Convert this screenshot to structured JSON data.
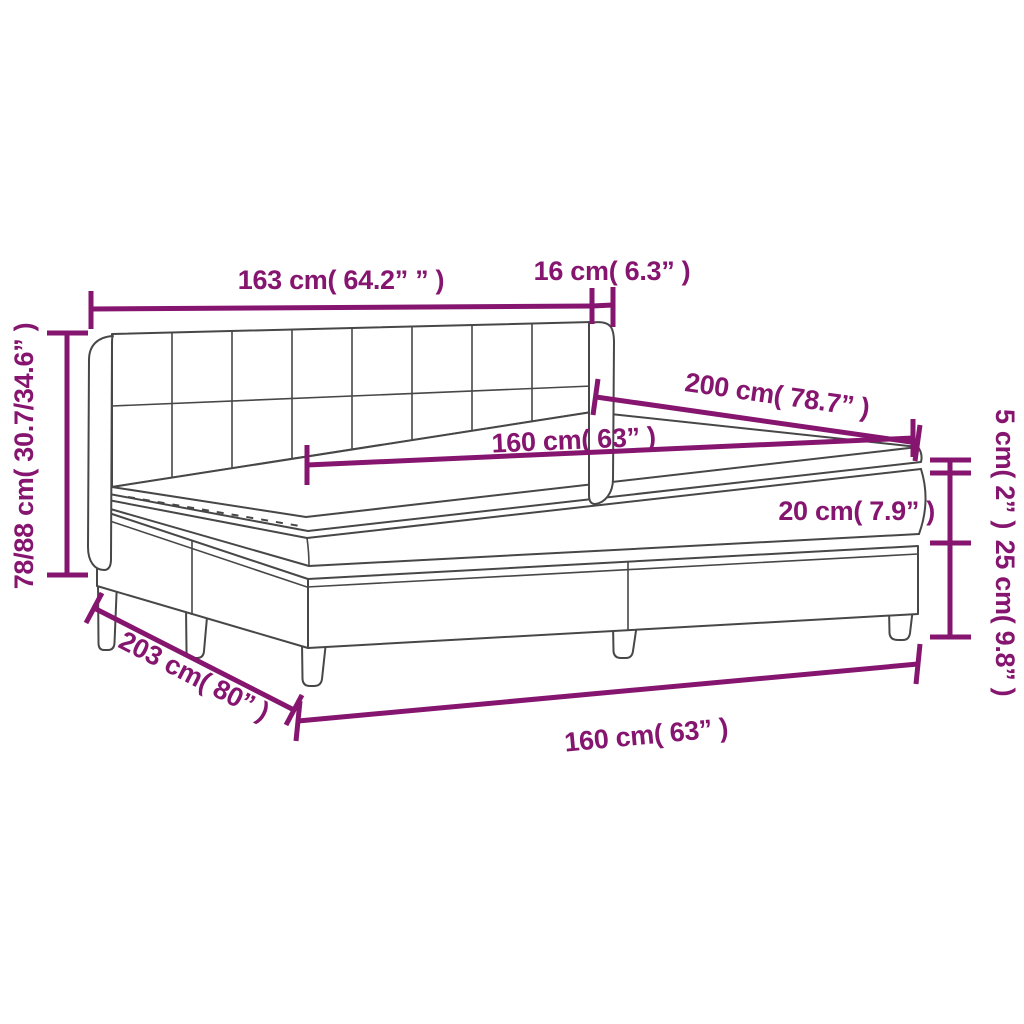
{
  "diagram": {
    "kind": "furniture-dimension-diagram",
    "subject": "box spring bed with checkered headboard, two-piece base, mattress and topper",
    "background_color": "#ffffff",
    "dimension_color": "#85156F",
    "outline_color": "#474747",
    "labels": {
      "headboard_width": "163 cm( 64.2” ” )",
      "headboard_side_depth": "16 cm( 6.3” )",
      "mattress_length": "200 cm( 78.7” )",
      "mattress_width_top": "160 cm( 63” )",
      "overall_height": "78/88 cm( 30.7/34.6” )",
      "topper_thickness": "5 cm( 2” )",
      "mattress_thickness": "20 cm( 7.9” )",
      "base_height": "25 cm( 9.8” )",
      "overall_length": "203 cm( 80” )",
      "base_width": "160 cm( 63” )"
    }
  }
}
